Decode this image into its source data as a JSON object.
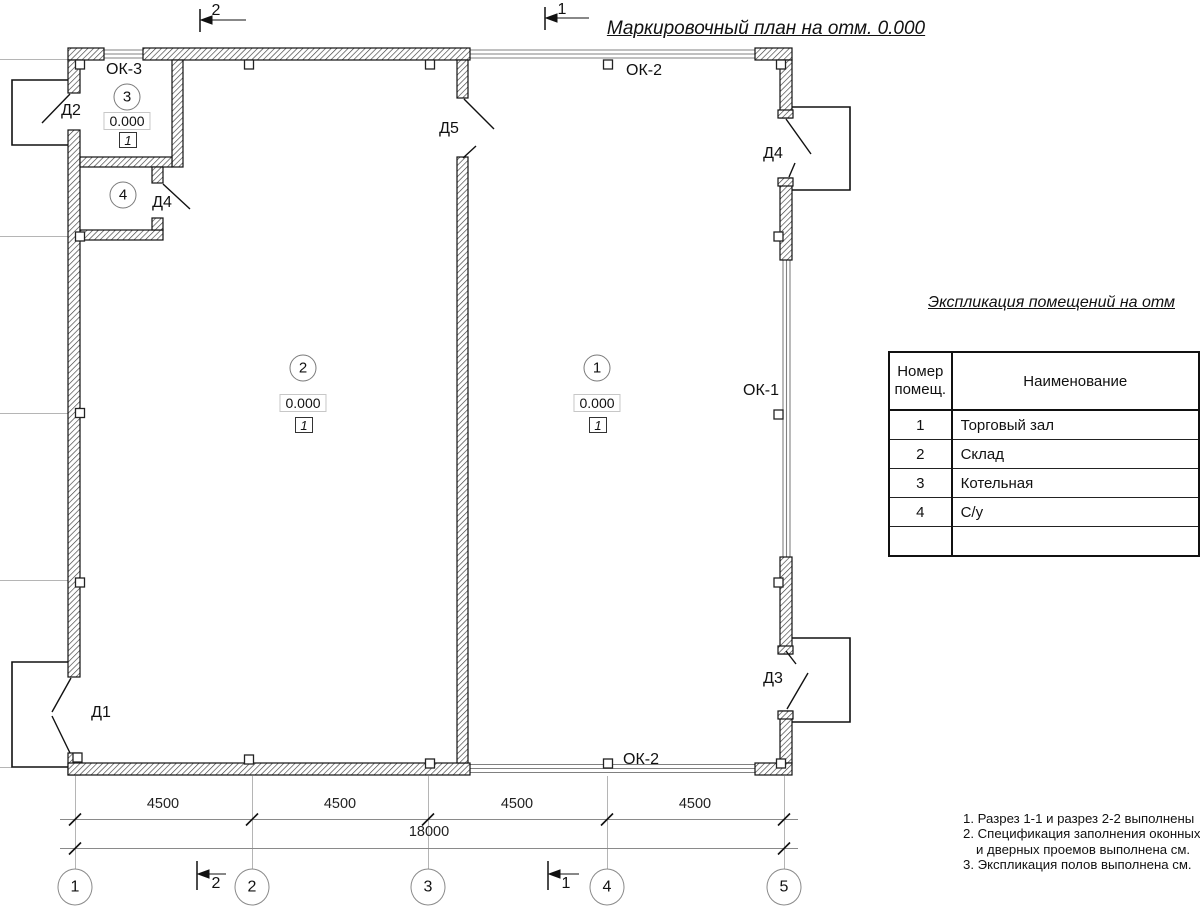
{
  "title": "Маркировочный план на отм. 0.000",
  "rooms": {
    "r1": {
      "number": "1",
      "elevation": "0.000",
      "floor_type": "1"
    },
    "r2": {
      "number": "2",
      "elevation": "0.000",
      "floor_type": "1"
    },
    "r3": {
      "number": "3",
      "elevation": "0.000",
      "floor_type": "1"
    },
    "r4": {
      "number": "4"
    }
  },
  "doors": {
    "d1": "Д1",
    "d2": "Д2",
    "d3": "Д3",
    "d4": "Д4",
    "d4_wc": "Д4",
    "d5": "Д5"
  },
  "windows": {
    "ok1": "ОК-1",
    "ok2_top": "ОК-2",
    "ok2_bottom": "ОК-2",
    "ok3": "ОК-3"
  },
  "sections": {
    "s1": "1",
    "s2": "2"
  },
  "axes": {
    "a1": "1",
    "a2": "2",
    "a3": "3",
    "a4": "4",
    "a5": "5"
  },
  "dimensions": {
    "d1": "4500",
    "d2": "4500",
    "d3": "4500",
    "d4": "4500",
    "total": "18000"
  },
  "table": {
    "title": "Экспликация помещений на отм",
    "header": {
      "col1_line1": "Номер",
      "col1_line2": "помещ.",
      "col2": "Наименование"
    },
    "rows": [
      {
        "num": "1",
        "name": "Торговый зал"
      },
      {
        "num": "2",
        "name": "Склад"
      },
      {
        "num": "3",
        "name": "Котельная"
      },
      {
        "num": "4",
        "name": "С/у"
      }
    ]
  },
  "notes": {
    "line1": "1. Разрез 1-1 и разрез 2-2 выполнены",
    "line2": "2. Спецификация заполнения оконных",
    "line3": "и дверных проемов выполнена см.",
    "line4": "3. Экспликация полов выполнена см."
  },
  "colors": {
    "line": "#1a1a1a",
    "grid": "#b5b5b5",
    "dim_line": "#8a8a8a",
    "window": "#808080"
  }
}
